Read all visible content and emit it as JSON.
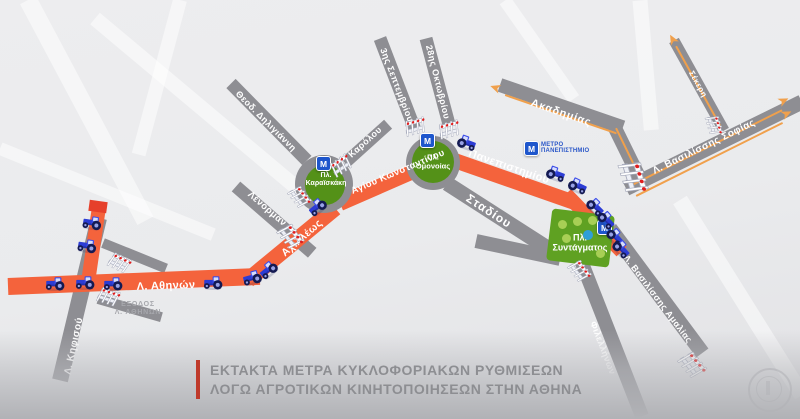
{
  "map": {
    "streets": {
      "kifisou": "Λ. Κηφισού",
      "athinon": "Λ. Αθηνών",
      "achilleos": "Αχιλλέως",
      "lenorman": "Λένορμαν",
      "deligianni": "Θεοδ. Δηλιγιάννη",
      "karolou": "Καρόλου",
      "agiou_konstantinou": "Αγίου Κωνσταντίνου",
      "septemvriou": "3ης Σεπτεμβρίου",
      "oktovriou": "28ης Οκτωβρίου",
      "panepistimiou": "Πανεπιστημίου",
      "stadiou": "Σταδίου",
      "akadimias": "Ακαδημίας",
      "sekeri": "Σέκερη",
      "vasilissis_sofias": "Λ. Βασιλίσσης Σοφίας",
      "vasilissis_amalias": "Λ. Βασιλίσσης Αμαλίας",
      "filellinon": "Φιλελλήνων"
    },
    "squares": {
      "karaiskaki_line1": "Πλ.",
      "karaiskaki_line2": "Καραϊσκάκη",
      "omonoia_line1": "Πλ.",
      "omonoia_line2": "Ομονοίας",
      "syntagma_line1": "Πλ.",
      "syntagma_line2": "Συντάγματος"
    },
    "metro": {
      "m": "M",
      "station_line1": "ΜΕΤΡΟ",
      "station_line2": "ΠΑΝΕΠΙΣΤΗΜΙΟ"
    },
    "exit_label": {
      "line1": "ΕΞΟΔΟΣ",
      "line2": "Λ. ΑΘΗΝΩΝ"
    }
  },
  "banner": {
    "line1": "ΕΚΤΑΚΤΑ ΜΕΤΡΑ ΚΥΚΛΟΦΟΡΙΑΚΩΝ ΡΥΘΜΙΣΕΩΝ",
    "line2": "ΛΟΓΩ ΑΓΡΟΤΙΚΩΝ ΚΙΝΗΤΟΠΟΙΗΣΕΩΝ ΣΤΗΝ ΑΘΗΝΑ",
    "accent_color": "#bf3a2b"
  },
  "colors": {
    "road_gray": "#8e8e93",
    "route_orange": "#f4633c",
    "route_line_orange": "#f0a04c",
    "park_green": "#549118",
    "metro_blue": "#1e56cc",
    "barrier_red": "#e01e1e",
    "tractor_blue": "#2c3cd4"
  },
  "icons": {
    "tractor": "tractor-icon",
    "barrier": "barrier-icon",
    "metro": "metro-icon",
    "route_arrow": "route-arrow-icon",
    "watermark": "police-emblem-watermark"
  }
}
